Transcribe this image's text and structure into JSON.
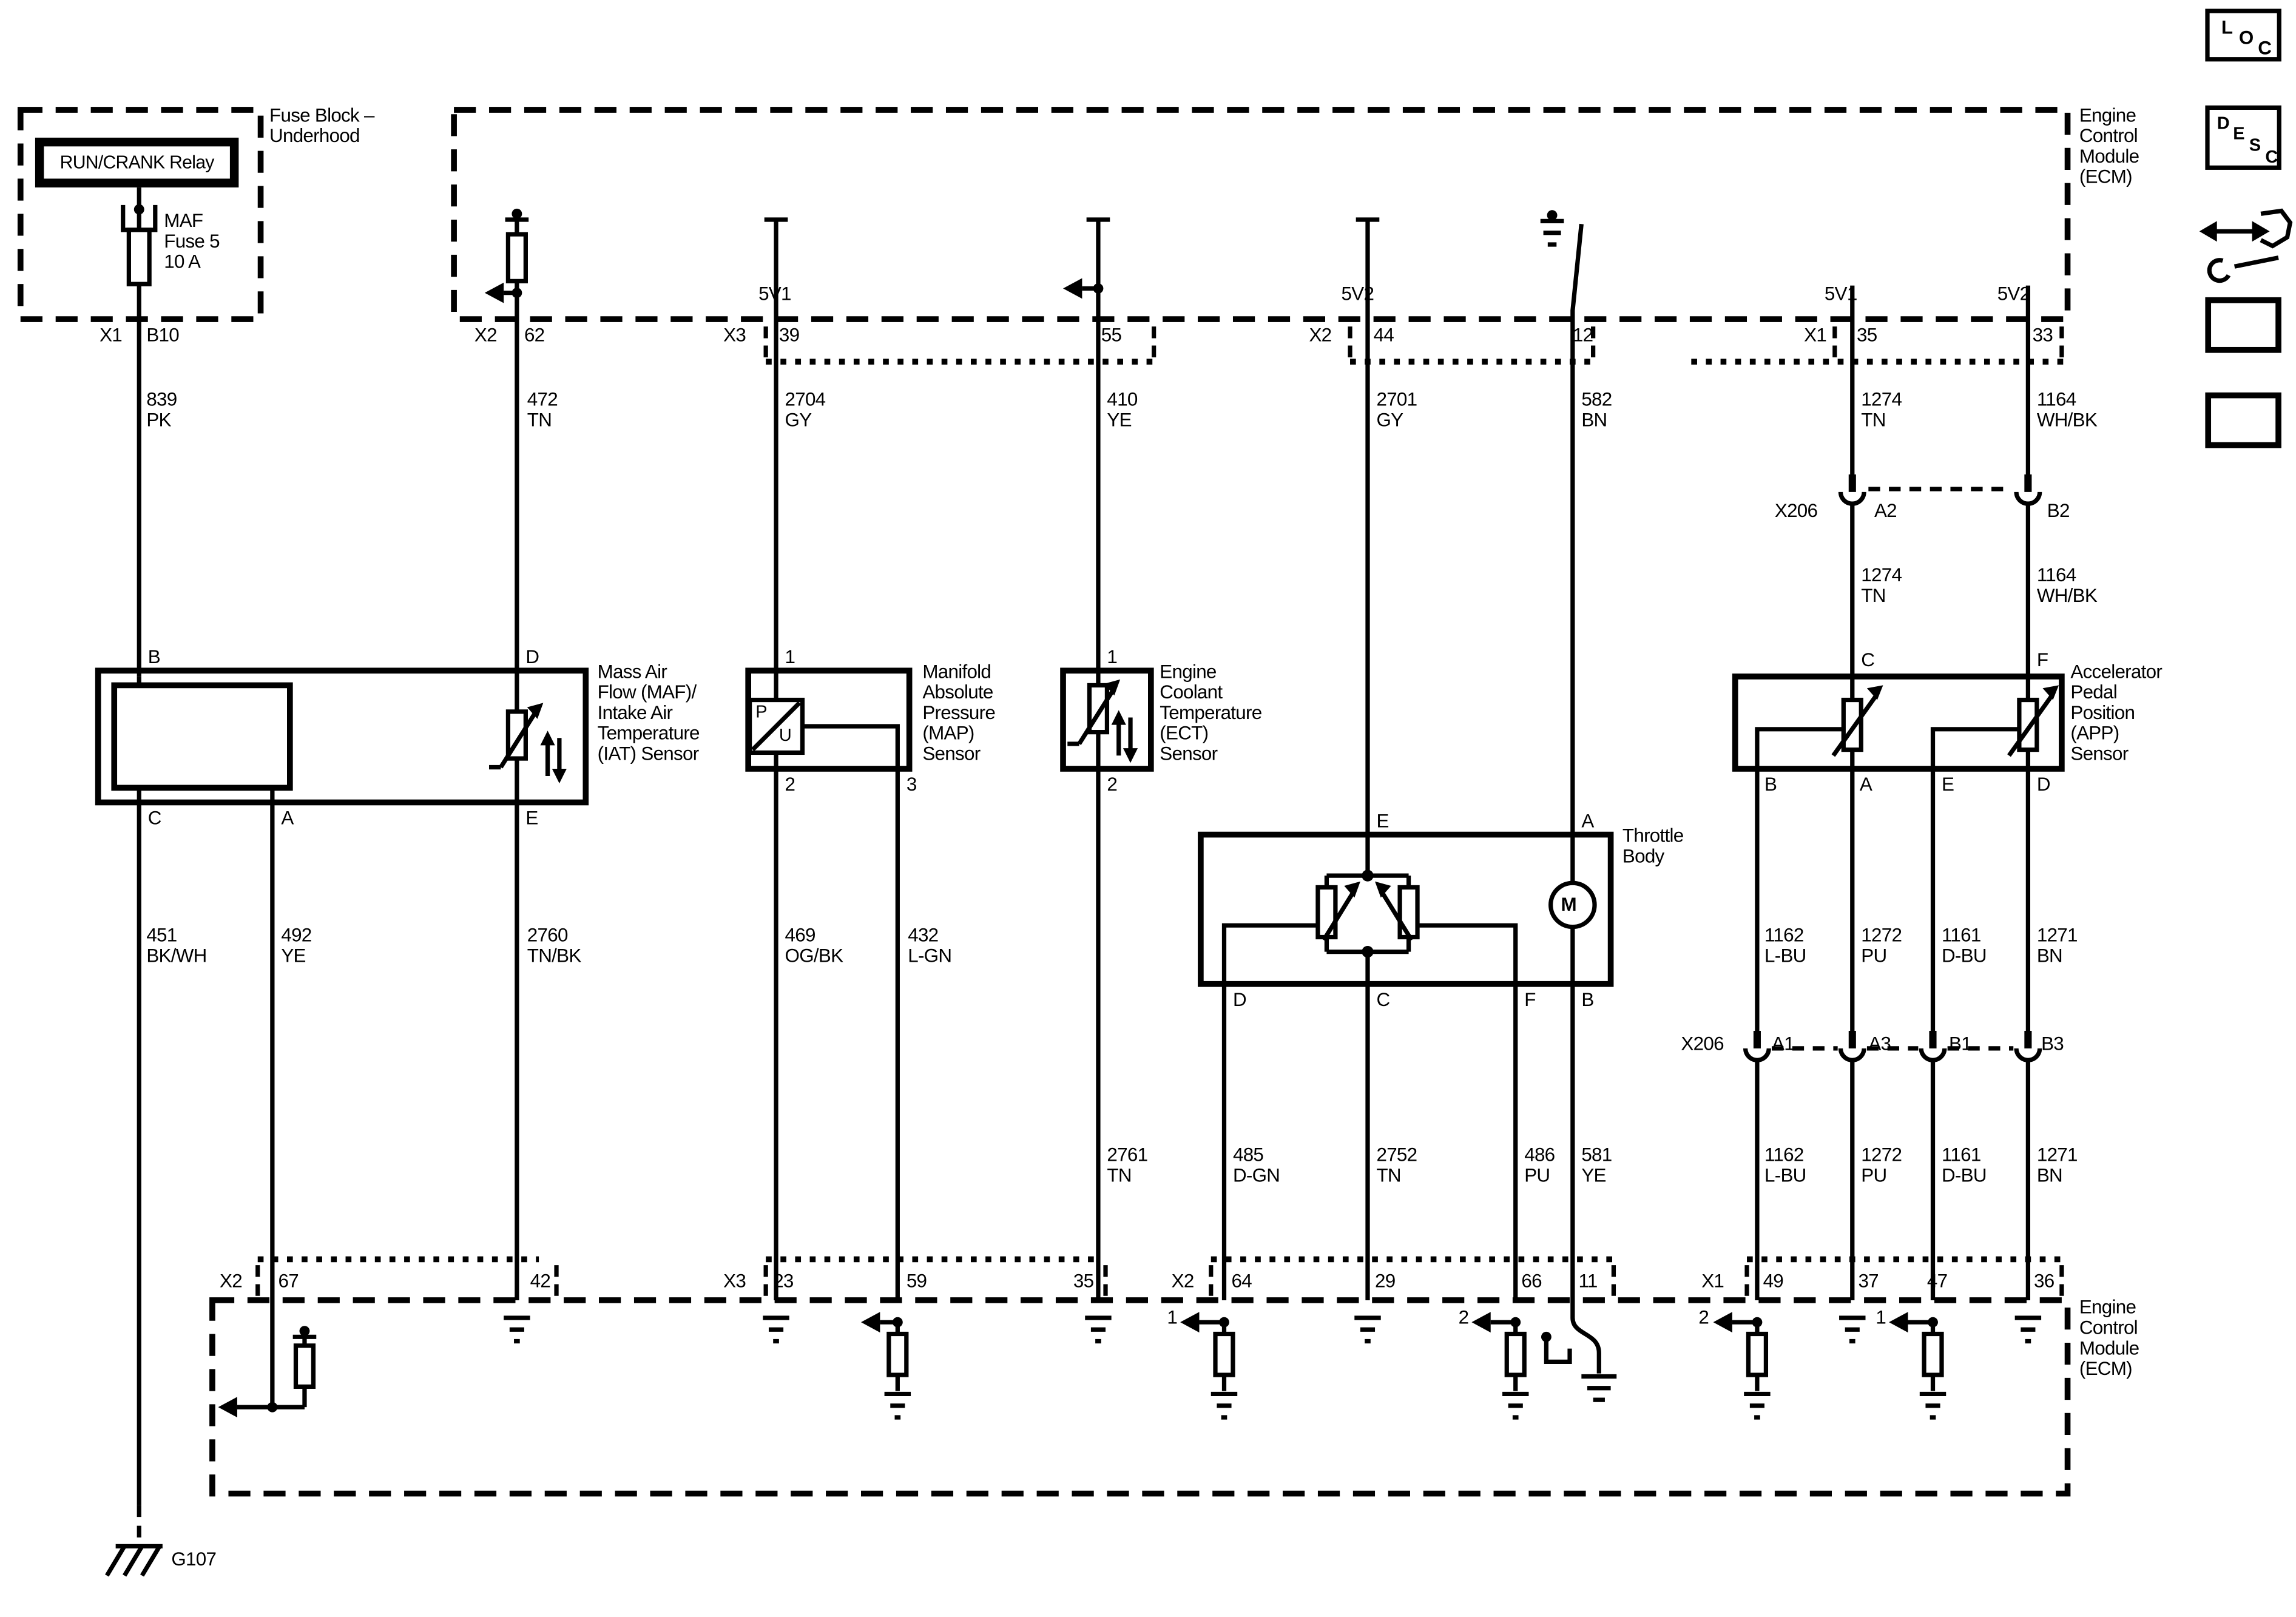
{
  "toolbar": {
    "loc": [
      "L",
      "O",
      "C"
    ],
    "desc": [
      "D",
      "E",
      "S",
      "C"
    ]
  },
  "fuse_block": {
    "title": [
      "Fuse Block –",
      "Underhood"
    ],
    "relay_label": "RUN/CRANK Relay",
    "fuse_label": [
      "MAF",
      "Fuse 5",
      "10 A"
    ],
    "conn": "X1",
    "pin": "B10"
  },
  "ecm_top": {
    "title": [
      "Engine",
      "Control",
      "Module",
      "(ECM)"
    ],
    "pins": {
      "p62": {
        "conn": "X2",
        "pin": "62"
      },
      "p39": {
        "conn": "X3",
        "pin": "39",
        "supply": "5V1"
      },
      "p55": {
        "pin": "55"
      },
      "p44": {
        "conn": "X2",
        "pin": "44",
        "supply": "5V2"
      },
      "p12": {
        "pin": "12"
      },
      "p35": {
        "conn": "X1",
        "pin": "35",
        "supply": "5V1"
      },
      "p33": {
        "pin": "33",
        "supply": "5V2"
      }
    }
  },
  "ecm_bottom": {
    "title": [
      "Engine",
      "Control",
      "Module",
      "(ECM)"
    ],
    "pins": {
      "x2a": "X2",
      "p67": "67",
      "p42": "42",
      "x3": "X3",
      "p23": "23",
      "p59": "59",
      "p35": "35",
      "x2b": "X2",
      "p64": "64",
      "p29": "29",
      "p66": "66",
      "p11": "11",
      "x1": "X1",
      "p49": "49",
      "p37": "37",
      "p47": "47",
      "p36": "36"
    },
    "ref_nums": {
      "n64": "1",
      "n66": "2",
      "n49": "2",
      "n47": "1"
    }
  },
  "wires": {
    "w839": [
      "839",
      "PK"
    ],
    "w472": [
      "472",
      "TN"
    ],
    "w2704": [
      "2704",
      "GY"
    ],
    "w410": [
      "410",
      "YE"
    ],
    "w2701": [
      "2701",
      "GY"
    ],
    "w582": [
      "582",
      "BN"
    ],
    "w1274": [
      "1274",
      "TN"
    ],
    "w1164": [
      "1164",
      "WH/BK"
    ],
    "w451": [
      "451",
      "BK/WH"
    ],
    "w492": [
      "492",
      "YE"
    ],
    "w2760": [
      "2760",
      "TN/BK"
    ],
    "w469": [
      "469",
      "OG/BK"
    ],
    "w432": [
      "432",
      "L-GN"
    ],
    "w2761": [
      "2761",
      "TN"
    ],
    "w485": [
      "485",
      "D-GN"
    ],
    "w2752": [
      "2752",
      "TN"
    ],
    "w486": [
      "486",
      "PU"
    ],
    "w581": [
      "581",
      "YE"
    ],
    "w1162": [
      "1162",
      "L-BU"
    ],
    "w1272": [
      "1272",
      "PU"
    ],
    "w1161": [
      "1161",
      "D-BU"
    ],
    "w1271": [
      "1271",
      "BN"
    ]
  },
  "x206_top": {
    "name": "X206",
    "pin_a": "A2",
    "pin_b": "B2"
  },
  "x206_bottom": {
    "name": "X206",
    "pins": [
      "A1",
      "A3",
      "B1",
      "B3"
    ]
  },
  "maf": {
    "title": [
      "Mass Air",
      "Flow (MAF)/",
      "Intake Air",
      "Temperature",
      "(IAT) Sensor"
    ],
    "pins": {
      "b": "B",
      "d": "D",
      "c": "C",
      "a": "A",
      "e": "E"
    }
  },
  "map": {
    "title": [
      "Manifold",
      "Absolute",
      "Pressure",
      "(MAP)",
      "Sensor"
    ],
    "symbol": [
      "P",
      "U"
    ],
    "pins": [
      "1",
      "2",
      "3"
    ]
  },
  "ect": {
    "title": [
      "Engine",
      "Coolant",
      "Temperature",
      "(ECT)",
      "Sensor"
    ],
    "pins": [
      "1",
      "2"
    ]
  },
  "throttle": {
    "title": [
      "Throttle",
      "Body"
    ],
    "motor": "M",
    "pins": {
      "e": "E",
      "a": "A",
      "d": "D",
      "c": "C",
      "f": "F",
      "b": "B"
    }
  },
  "app": {
    "title": [
      "Accelerator",
      "Pedal",
      "Position",
      "(APP)",
      "Sensor"
    ],
    "pins": {
      "c": "C",
      "f": "F",
      "b": "B",
      "a": "A",
      "e": "E",
      "d": "D"
    }
  },
  "ground": {
    "label": "G107"
  }
}
